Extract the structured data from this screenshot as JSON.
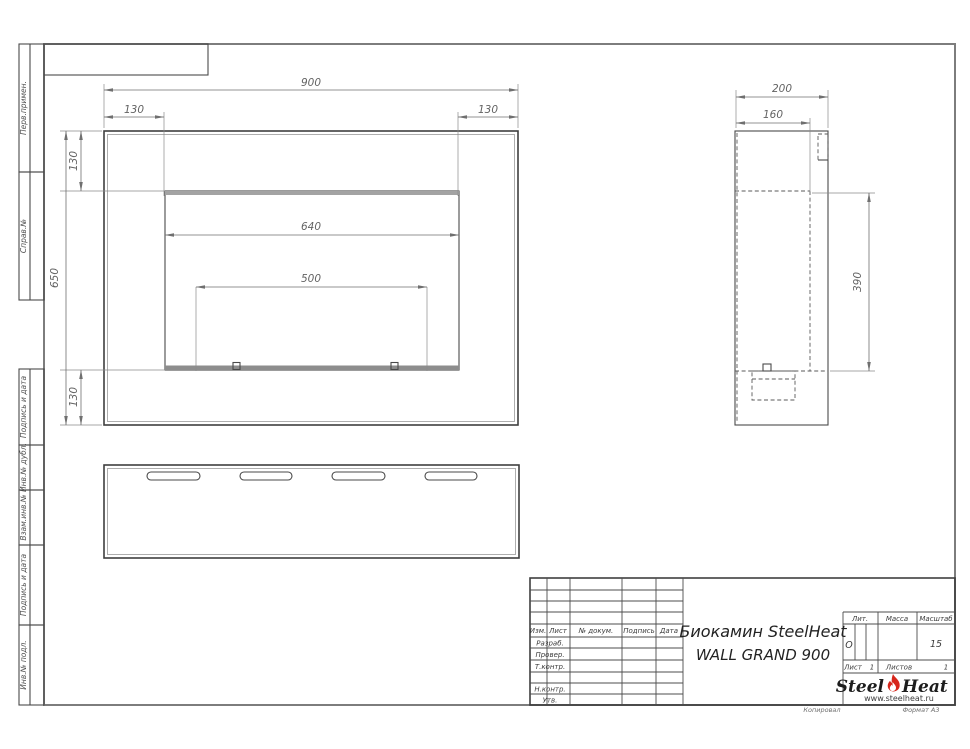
{
  "margin_labels": [
    "Перв.примен.",
    "Справ.№",
    "Подпись и дата",
    "Инв.№ дубл.",
    "Взам.инв.№",
    "Подпись и дата",
    "Инв.№ подл."
  ],
  "dimensions": {
    "front": {
      "width_total": "900",
      "offset_left": "130",
      "offset_right": "130",
      "border_top": "130",
      "height_total": "650",
      "border_bottom": "130",
      "opening_width": "640",
      "burner_width": "500"
    },
    "side": {
      "depth_total": "200",
      "depth_inner": "160",
      "opening_height": "390"
    }
  },
  "title_block": {
    "columns": [
      "Изм.",
      "Лист",
      "№ докум.",
      "Подпись",
      "Дата"
    ],
    "rows": [
      "Разраб.",
      "Провер.",
      "Т.контр.",
      "Н.контр.",
      "Утв."
    ],
    "product_line1": "Биокамин SteelHeat",
    "product_line2": "WALL GRAND 900",
    "lit_label": "Лит.",
    "lit_value": "О",
    "mass_label": "Масса",
    "scale_label": "Масштаб",
    "scale_value": "15",
    "sheet_label": "Лист",
    "sheet_value": "1",
    "sheets_label": "Листов",
    "sheets_value": "1",
    "brand_part1": "Steel",
    "brand_part2": "Heat",
    "brand_url": "www.steelheat.ru"
  },
  "footer": {
    "copied_label": "Копировал",
    "format_label": "Формат А3"
  },
  "colors": {
    "line": "#4a4a4a",
    "dimension": "#6f6f6f",
    "frame": "#7d7d7d",
    "flame_red": "#d7261b"
  }
}
